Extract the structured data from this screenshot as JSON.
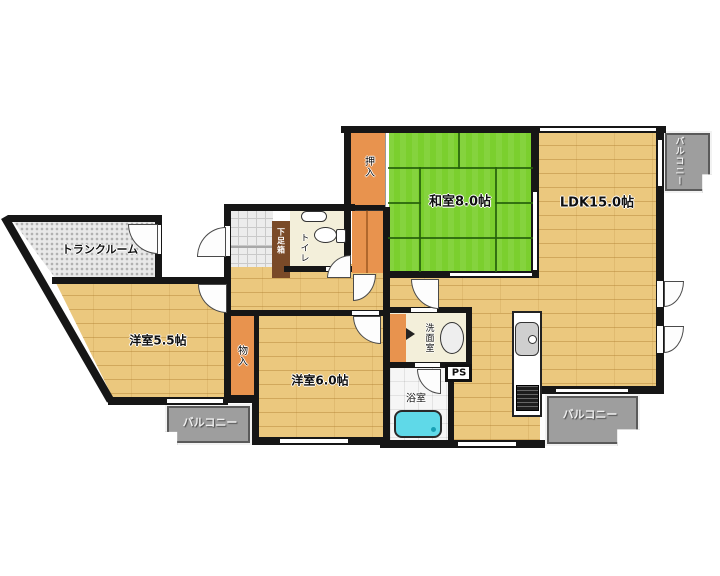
{
  "rooms": {
    "washitsu": {
      "label": "和室8.0帖"
    },
    "ldk": {
      "label": "LDK15.0帖"
    },
    "yoshitsu55": {
      "label": "洋室5.5帖"
    },
    "yoshitsu60": {
      "label": "洋室6.0帖"
    },
    "trunk": {
      "label": "トランクルーム"
    },
    "toilet": {
      "label": "トイレ"
    },
    "washroom": {
      "label": "洗面室"
    },
    "bath": {
      "label": "浴室"
    },
    "oshiire": {
      "label": "押入"
    },
    "mononyu": {
      "label": "物入"
    },
    "getabako": {
      "label": "下足箱"
    },
    "ps": {
      "label": "PS"
    },
    "balcony_top_right": {
      "label": "バルコニー"
    },
    "balcony_bottom_left": {
      "label": "バルコニー"
    },
    "balcony_bottom_right": {
      "label": "バルコニー"
    }
  },
  "colors": {
    "wood": "#ebc87e",
    "tatami_green": "#7bcf2e",
    "closet_orange": "#e8934e",
    "balcony_gray": "#9e9e9e",
    "bathtub_cyan": "#5fd9e8",
    "wall_black": "#161616",
    "shoebox_brown": "#7a4a28"
  }
}
